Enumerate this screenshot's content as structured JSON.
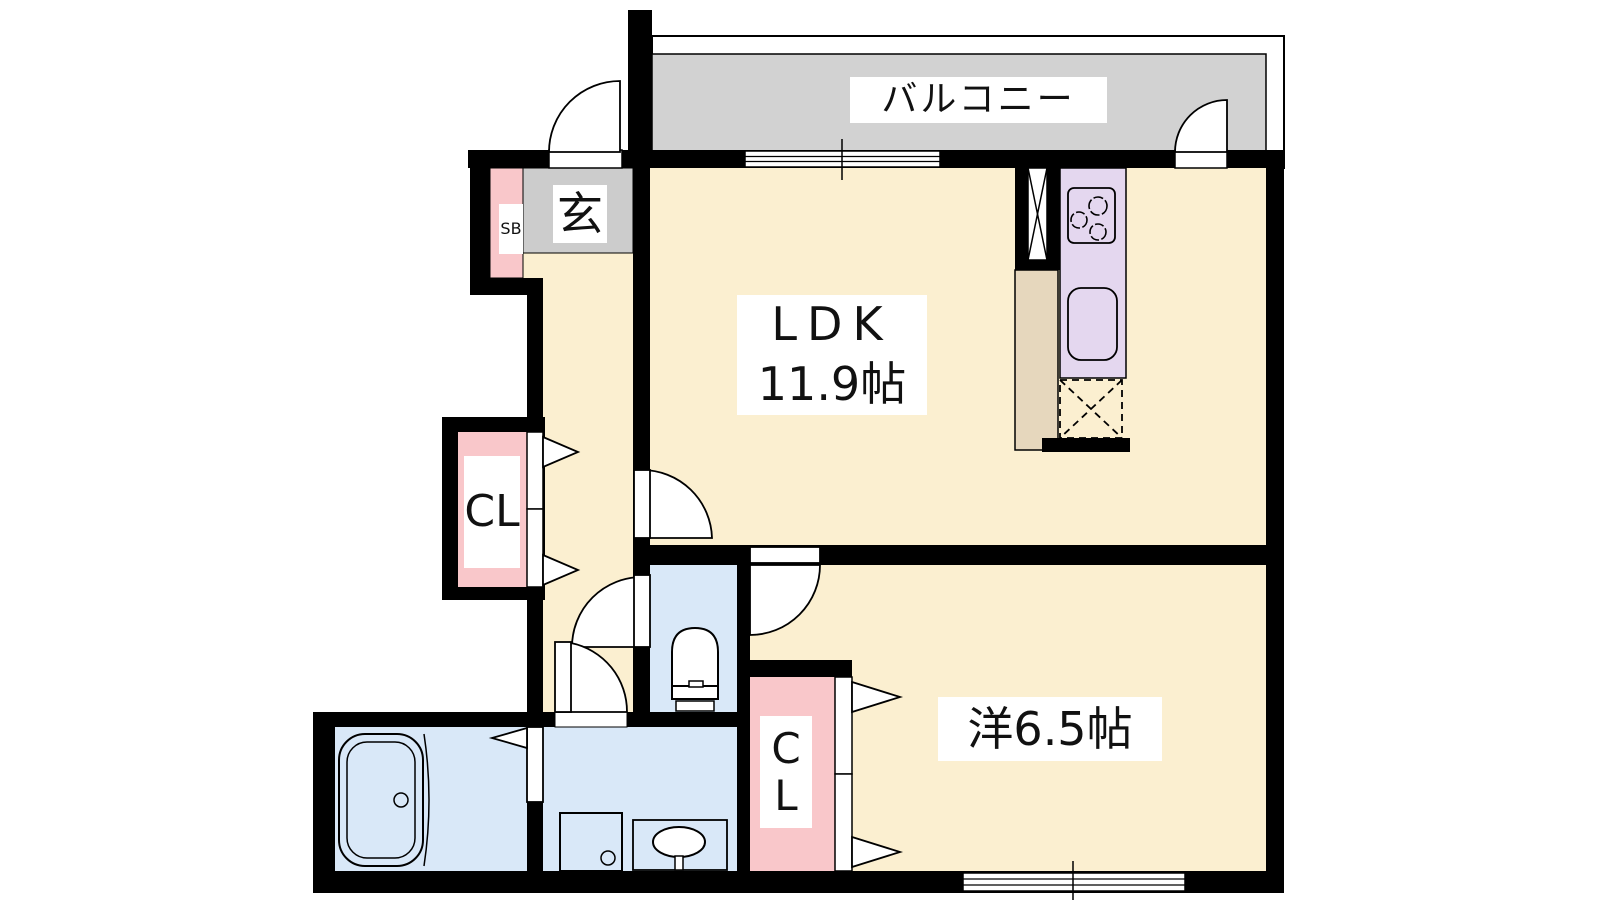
{
  "colors": {
    "wall": "#000000",
    "floor": "#fbefd0",
    "genkan_gray": "#cccccc",
    "balcony_gray": "#d2d2d2",
    "closet_pink": "#f9c7ca",
    "kitchen_purple": "#e4d7ef",
    "water_blue": "#d9e8f8",
    "counter_tan": "#e6d7bd"
  },
  "rooms": {
    "balcony": {
      "label": "バルコニー"
    },
    "entrance": {
      "label": "玄"
    },
    "shoe_box": {
      "label": "SB"
    },
    "ldk": {
      "label": "LDK",
      "size": "11.9帖"
    },
    "western_room": {
      "label": "洋6.5帖"
    },
    "hall_closet": {
      "label": "CL"
    },
    "bedroom_closet": {
      "label": "CL"
    }
  }
}
